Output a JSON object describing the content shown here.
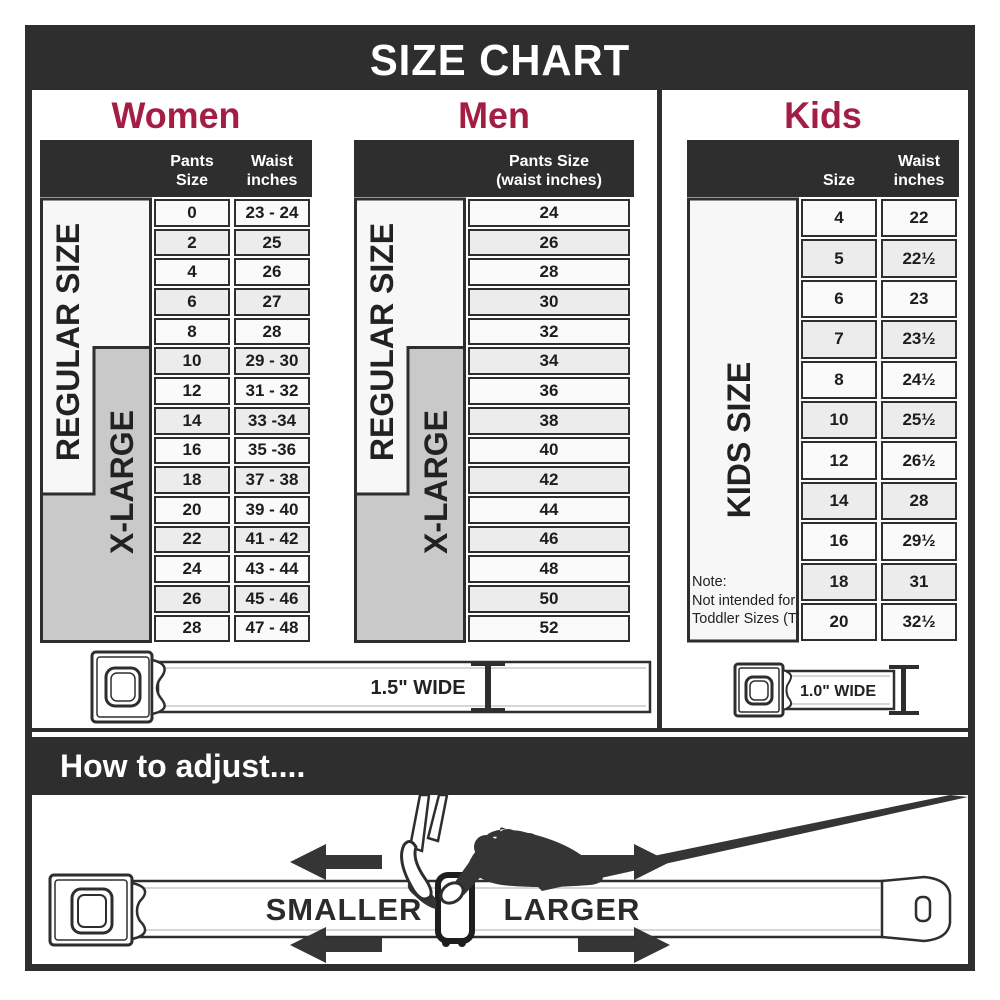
{
  "title": "SIZE CHART",
  "colors": {
    "accent": "#a41e44",
    "dark": "#2e2e2e",
    "band_gray": "#c9c9c9",
    "row_light": "#fafafa",
    "row_shaded": "#ececec"
  },
  "women": {
    "heading": "Women",
    "col1_header": "Pants Size",
    "col2_header_line1": "Waist",
    "col2_header_line2": "inches",
    "regular_label": "REGULAR SIZE",
    "xlarge_label": "X-LARGE",
    "rows": [
      {
        "size": "0",
        "waist": "23 - 24"
      },
      {
        "size": "2",
        "waist": "25"
      },
      {
        "size": "4",
        "waist": "26"
      },
      {
        "size": "6",
        "waist": "27"
      },
      {
        "size": "8",
        "waist": "28"
      },
      {
        "size": "10",
        "waist": "29 - 30"
      },
      {
        "size": "12",
        "waist": "31 - 32"
      },
      {
        "size": "14",
        "waist": "33 -34"
      },
      {
        "size": "16",
        "waist": "35 -36"
      },
      {
        "size": "18",
        "waist": "37 - 38"
      },
      {
        "size": "20",
        "waist": "39 - 40"
      },
      {
        "size": "22",
        "waist": "41 - 42"
      },
      {
        "size": "24",
        "waist": "43 - 44"
      },
      {
        "size": "26",
        "waist": "45 - 46"
      },
      {
        "size": "28",
        "waist": "47 - 48"
      }
    ]
  },
  "men": {
    "heading": "Men",
    "col_header_line1": "Pants Size",
    "col_header_line2": "(waist inches)",
    "regular_label": "REGULAR SIZE",
    "xlarge_label": "X-LARGE",
    "rows": [
      "24",
      "26",
      "28",
      "30",
      "32",
      "34",
      "36",
      "38",
      "40",
      "42",
      "44",
      "46",
      "48",
      "50",
      "52"
    ]
  },
  "kids": {
    "heading": "Kids",
    "col1_header": "Size",
    "col2_header_line1": "Waist",
    "col2_header_line2": "inches",
    "band_label": "KIDS SIZE",
    "note_line1": "Note:",
    "note_line2": "Not intended for",
    "note_line3": "Toddler Sizes (T)",
    "rows": [
      {
        "size": "4",
        "waist": "22"
      },
      {
        "size": "5",
        "waist": "22½"
      },
      {
        "size": "6",
        "waist": "23"
      },
      {
        "size": "7",
        "waist": "23½"
      },
      {
        "size": "8",
        "waist": "24½"
      },
      {
        "size": "10",
        "waist": "25½"
      },
      {
        "size": "12",
        "waist": "26½"
      },
      {
        "size": "14",
        "waist": "28"
      },
      {
        "size": "16",
        "waist": "29½"
      },
      {
        "size": "18",
        "waist": "31"
      },
      {
        "size": "20",
        "waist": "32½"
      }
    ]
  },
  "belts": {
    "adult_label": "1.5\" WIDE",
    "kids_label": "1.0\" WIDE"
  },
  "adjust": {
    "heading": "How to adjust....",
    "smaller": "SMALLER",
    "larger": "LARGER"
  }
}
